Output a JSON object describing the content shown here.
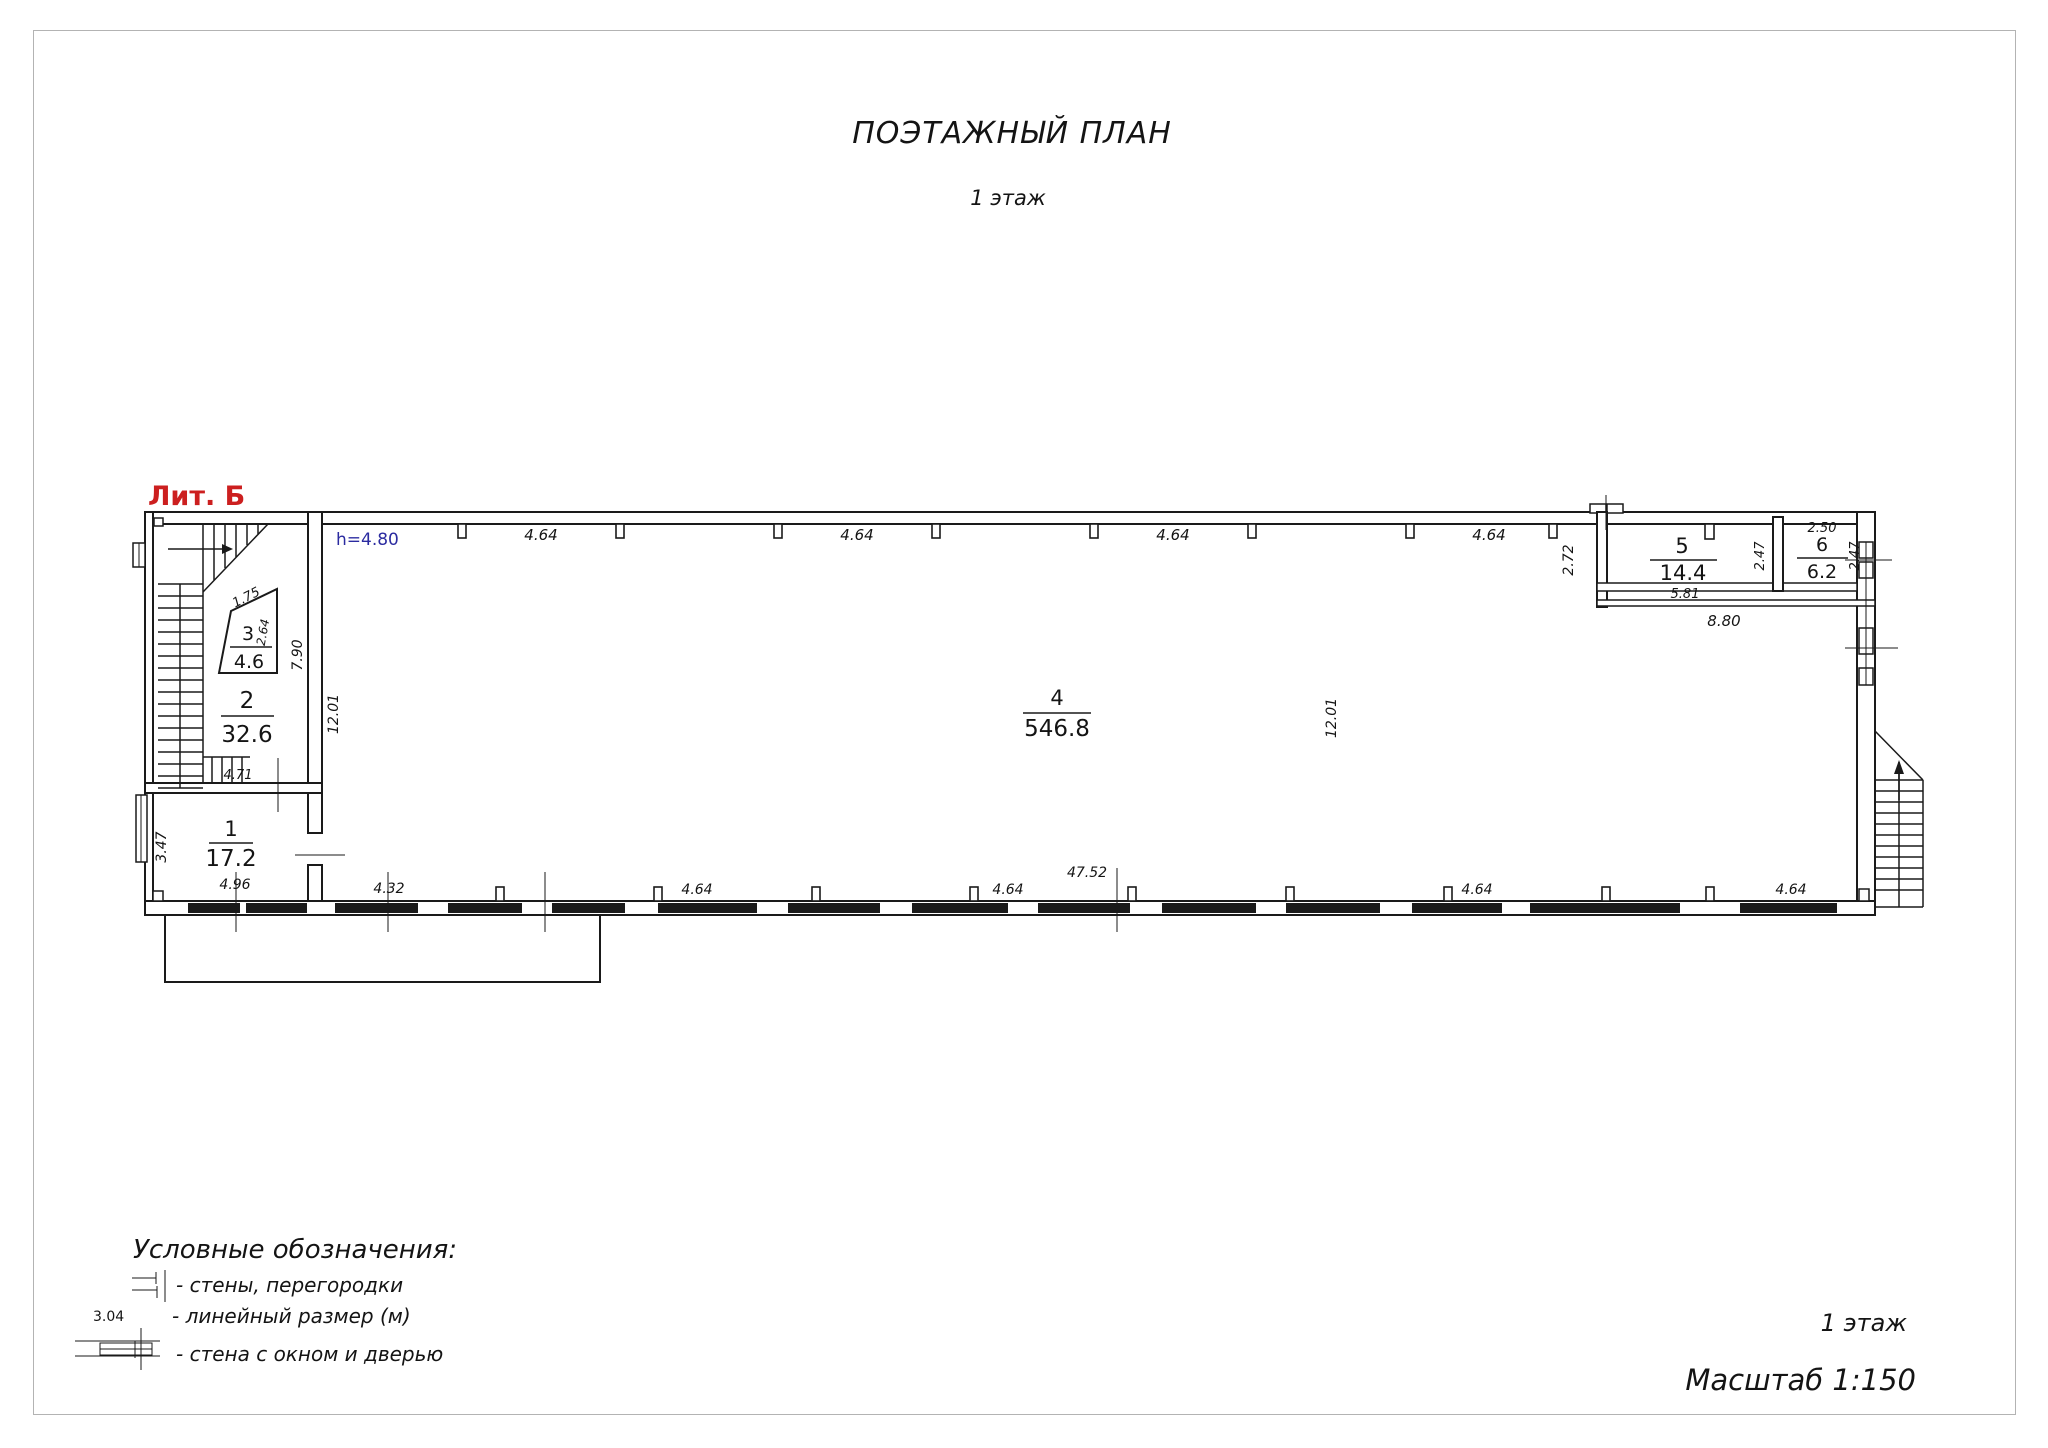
{
  "page": {
    "title": "ПОЭТАЖНЫЙ ПЛАН",
    "subtitle": "1 этаж"
  },
  "plan": {
    "liter": "Лит. Б",
    "height_note": "h=4.80",
    "colors": {
      "liter": "#cc1f1f",
      "height_note": "#2b2ba0",
      "lines": "#1a1a1a"
    },
    "rooms": [
      {
        "num": "1",
        "area": "17.2"
      },
      {
        "num": "2",
        "area": "32.6"
      },
      {
        "num": "3",
        "area": "4.6"
      },
      {
        "num": "4",
        "area": "546.8"
      },
      {
        "num": "5",
        "area": "14.4"
      },
      {
        "num": "6",
        "area": "6.2"
      }
    ],
    "dims": {
      "top": [
        "4.64",
        "4.64",
        "4.64",
        "4.64"
      ],
      "bottom": [
        "4.32",
        "4.64",
        "4.64",
        "47.52",
        "4.64",
        "4.64"
      ],
      "left_inner": "12.01",
      "hall_mid": "12.01",
      "room2_height": "7.90",
      "room2_width": "4.71",
      "room1_height": "3.47",
      "room1_width": "4.96",
      "room3_width": "1.75",
      "room3_height": "2.64",
      "annex_left": "2.72",
      "annex_width": "8.80",
      "room5_width": "5.81",
      "room5_height": "2.47",
      "room6_width": "2.50",
      "room6_height": "2.47"
    }
  },
  "legend": {
    "title": "Условные обозначения:",
    "items": [
      {
        "label": "- стены, перегородки"
      },
      {
        "size": "3.04",
        "label": "- линейный размер (м)"
      },
      {
        "label": "- стена с окном и дверью"
      }
    ]
  },
  "footer": {
    "floor": "1 этаж",
    "scale": "Масштаб 1:150"
  }
}
